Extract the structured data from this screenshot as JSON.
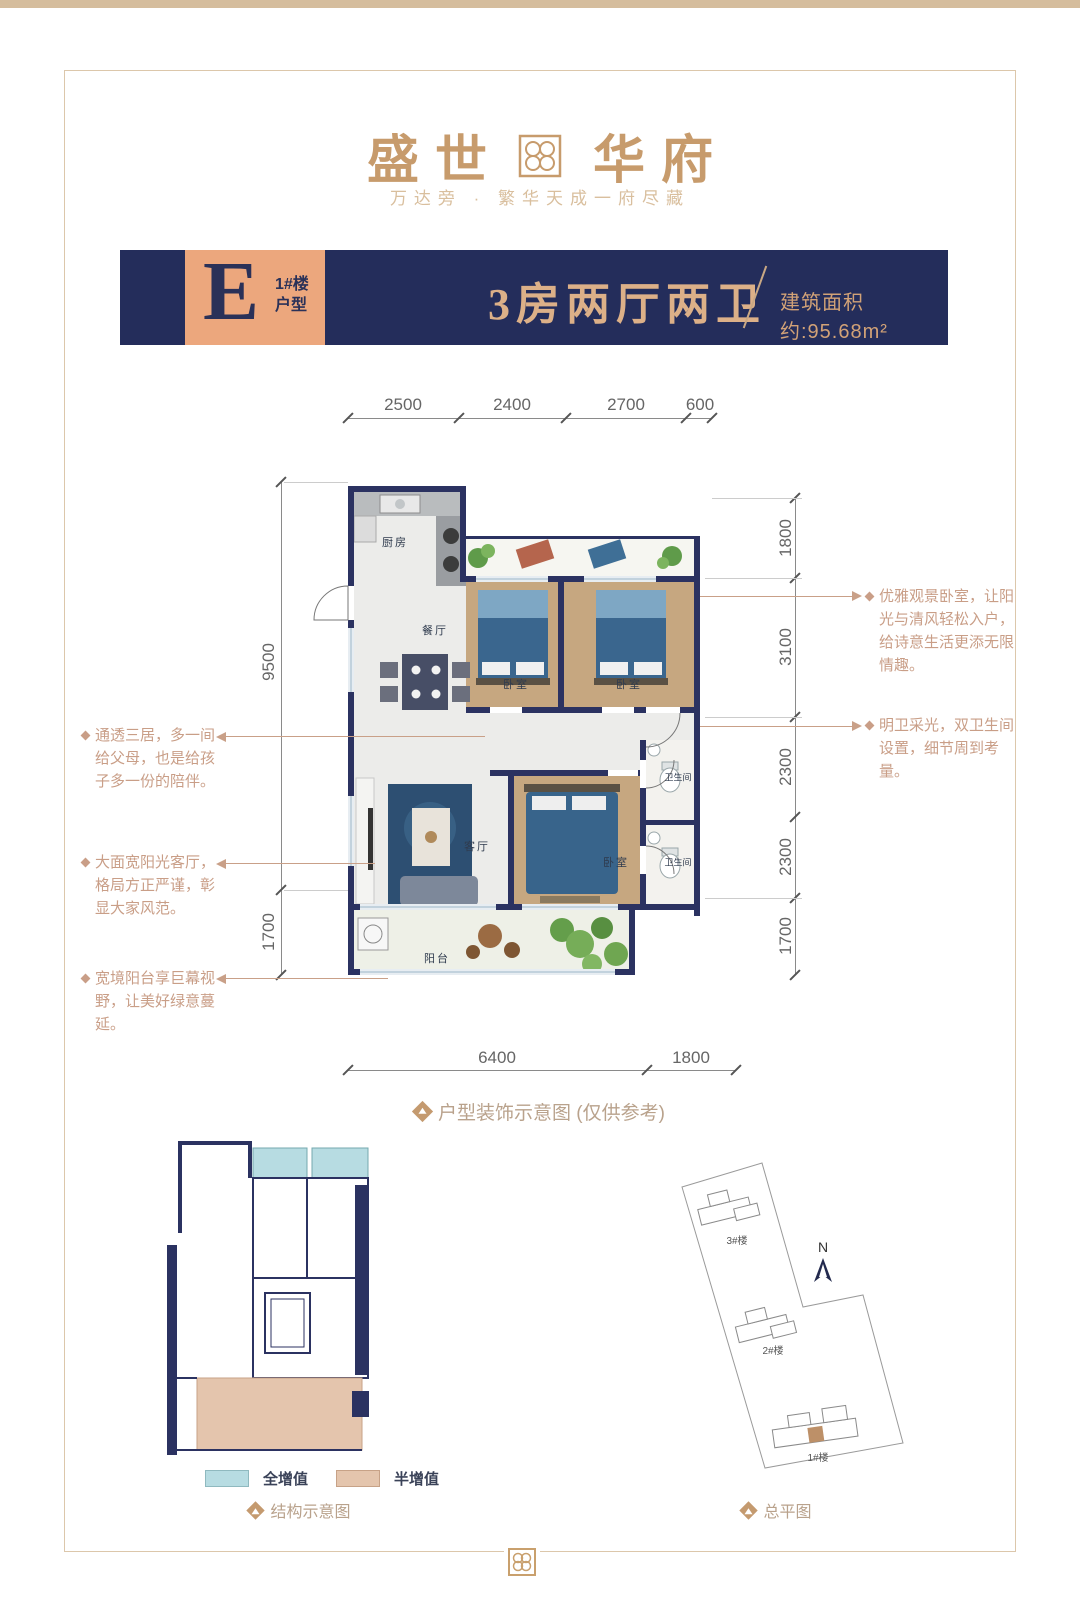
{
  "brand": {
    "title_left": "盛世",
    "title_right": "华府",
    "subtitle": "万达旁 · 繁华天成一府尽藏"
  },
  "header": {
    "unit_letter": "E",
    "building_no": "1#楼",
    "type_label": "户型",
    "layout_title": "3房两厅两卫",
    "area_text": "建筑面积约:95.68m²"
  },
  "plan": {
    "caption": "户型装饰示意图 (仅供参考)",
    "rooms": {
      "kitchen": "厨房",
      "dining": "餐厅",
      "bedroom1": "卧室",
      "bedroom2": "卧室",
      "master": "卧室",
      "living": "客厅",
      "bath1": "卫生间",
      "bath2": "卫生间",
      "balcony": "阳台"
    },
    "dims": {
      "top": [
        "2500",
        "2400",
        "2700",
        "600"
      ],
      "left": [
        "9500",
        "1700"
      ],
      "right": [
        "1800",
        "3100",
        "2300",
        "2300",
        "1700"
      ],
      "bottom": [
        "6400",
        "1800"
      ]
    },
    "callouts": {
      "left": [
        {
          "text": "通透三居，多一间给父母，也是给孩子多一份的陪伴。"
        },
        {
          "text": "大面宽阳光客厅，格局方正严谨，彰显大家风范。"
        },
        {
          "text": "宽境阳台享巨幕视野，让美好绿意蔓延。"
        }
      ],
      "right": [
        {
          "text": "优雅观景卧室，让阳光与清风轻松入户，给诗意生活更添无限情趣。"
        },
        {
          "text": "明卫采光，双卫生间设置，细节周到考量。"
        }
      ]
    }
  },
  "structure": {
    "caption": "结构示意图",
    "legend": [
      {
        "label": "全增值",
        "color": "#b7dce2"
      },
      {
        "label": "半增值",
        "color": "#e4c5ad"
      }
    ]
  },
  "siteplan": {
    "caption": "总平图",
    "north_label": "N",
    "buildings": [
      "3#楼",
      "2#楼",
      "1#楼"
    ]
  },
  "colors": {
    "navy": "#242d5b",
    "tan_block": "#eca77d",
    "gold_text": "#c79b6c",
    "annotation": "#c99e87"
  }
}
